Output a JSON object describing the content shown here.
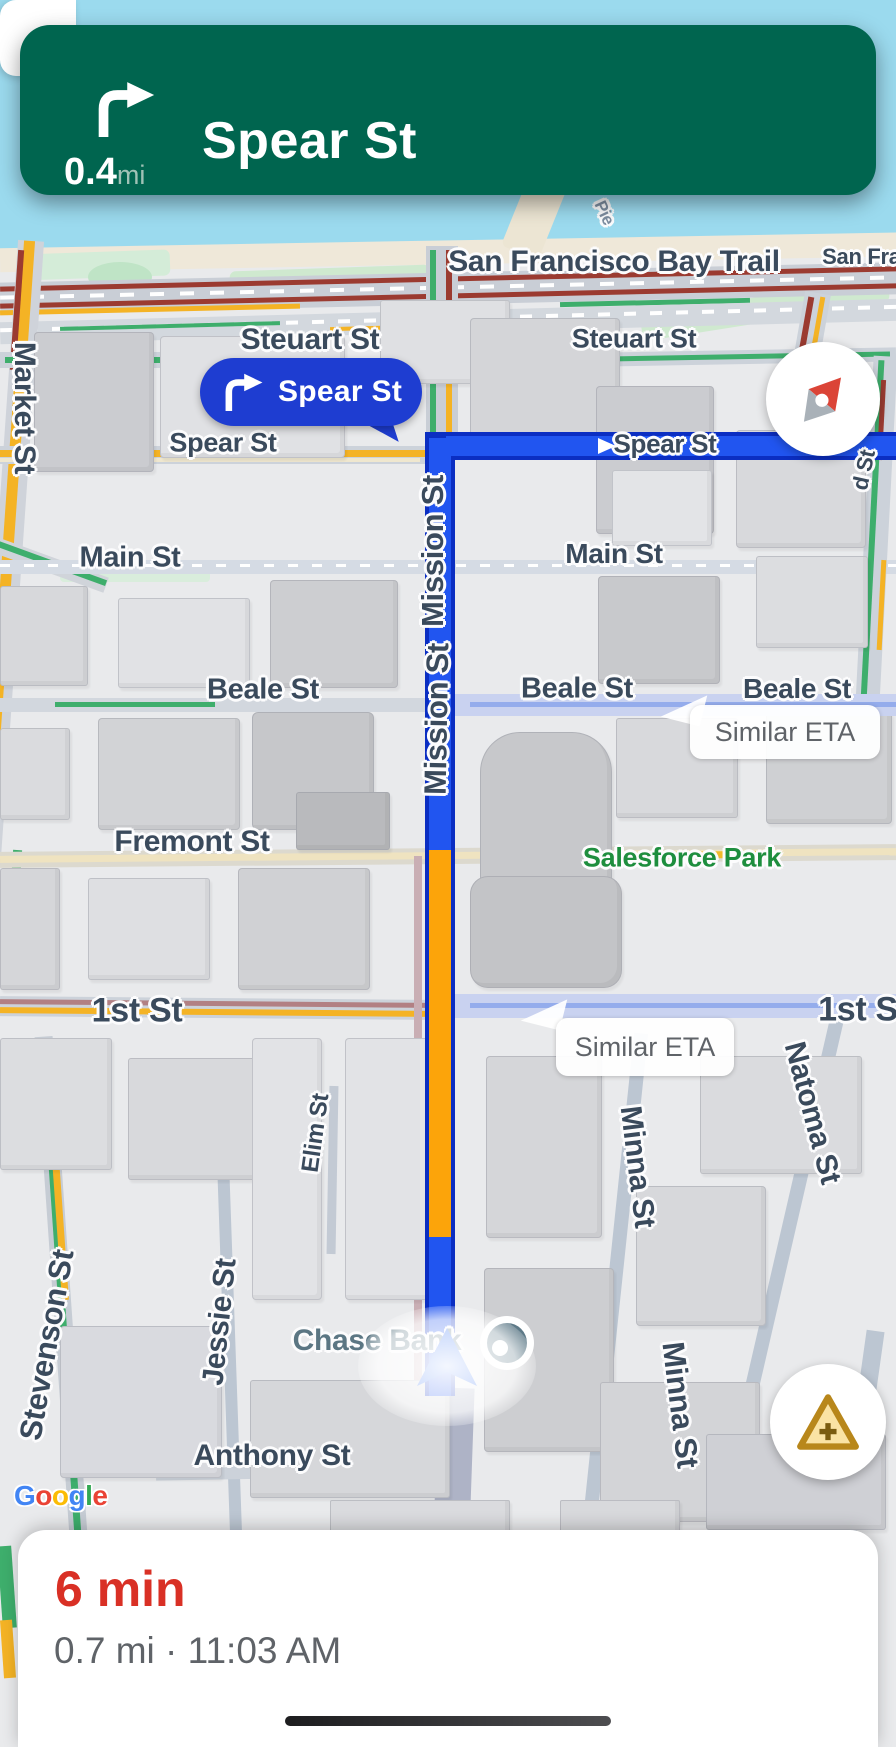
{
  "nav_banner": {
    "instruction": "Spear St",
    "distance_value": "0.4",
    "distance_unit": "mi",
    "maneuver_icon": "turn-right"
  },
  "turn_callout": {
    "label": "Spear St"
  },
  "eta_callouts": [
    "Similar ETA",
    "Similar ETA"
  ],
  "map_controls": {
    "collapse_label": "<"
  },
  "bottom_panel": {
    "eta": "6 min",
    "details": "0.7 mi · 11:03 AM"
  },
  "attribution": {
    "letters": [
      {
        "ch": "G",
        "color": "#4285F4"
      },
      {
        "ch": "o",
        "color": "#EA4335"
      },
      {
        "ch": "o",
        "color": "#FBBC05"
      },
      {
        "ch": "g",
        "color": "#4285F4"
      },
      {
        "ch": "l",
        "color": "#34A853"
      },
      {
        "ch": "e",
        "color": "#EA4335"
      }
    ]
  },
  "colors": {
    "banner_green": "#00654F",
    "route_blue": "#2155F0",
    "route_casing": "#0B2EC2",
    "traffic_orange": "#FCA40A",
    "alt_route": "#C9D2F0",
    "eta_red": "#D93025",
    "callout_blue": "#1E3DD1",
    "water": "#9BDAEE"
  },
  "map": {
    "street_labels": [
      {
        "id": "san-francisco-bay-trail",
        "text": "San Francisco Bay Trail",
        "x": 614,
        "y": 262,
        "rot": 0,
        "size": 30
      },
      {
        "id": "san-francisco-2",
        "text": "San Fran",
        "x": 868,
        "y": 257,
        "rot": 0,
        "size": 22
      },
      {
        "id": "pier",
        "text": "Pie",
        "x": 604,
        "y": 213,
        "rot": 65,
        "size": 17,
        "color": "#7D8DA0"
      },
      {
        "id": "market-st",
        "text": "Market St",
        "x": 24,
        "y": 408,
        "rot": 90,
        "size": 30
      },
      {
        "id": "steuart-st-west",
        "text": "Steuart St",
        "x": 310,
        "y": 340,
        "rot": 0,
        "size": 30
      },
      {
        "id": "steuart-st-east",
        "text": "Steuart St",
        "x": 634,
        "y": 339,
        "rot": 0,
        "size": 27
      },
      {
        "id": "spear-st-west",
        "text": "Spear St",
        "x": 223,
        "y": 443,
        "rot": 0,
        "size": 27
      },
      {
        "id": "spear-st-east",
        "text": "Spear St",
        "x": 665,
        "y": 444,
        "rot": 0,
        "size": 26
      },
      {
        "id": "d-st",
        "text": "d St",
        "x": 864,
        "y": 470,
        "rot": -78,
        "size": 22
      },
      {
        "id": "main-st-west",
        "text": "Main St",
        "x": 130,
        "y": 558,
        "rot": 0,
        "size": 29
      },
      {
        "id": "main-st-east",
        "text": "Main St",
        "x": 614,
        "y": 554,
        "rot": 0,
        "size": 28
      },
      {
        "id": "mission-st-north",
        "text": "Mission St",
        "x": 433,
        "y": 551,
        "rot": -90,
        "size": 31
      },
      {
        "id": "mission-st-south",
        "text": "Mission St",
        "x": 437,
        "y": 719,
        "rot": -89,
        "size": 31
      },
      {
        "id": "beale-st-west",
        "text": "Beale St",
        "x": 263,
        "y": 690,
        "rot": 0,
        "size": 29
      },
      {
        "id": "beale-st-mid",
        "text": "Beale St",
        "x": 577,
        "y": 689,
        "rot": 0,
        "size": 29
      },
      {
        "id": "beale-st-east",
        "text": "Beale St",
        "x": 797,
        "y": 689,
        "rot": 0,
        "size": 28
      },
      {
        "id": "fremont-st",
        "text": "Fremont St",
        "x": 192,
        "y": 842,
        "rot": 0,
        "size": 30
      },
      {
        "id": "salesforce-park",
        "text": "Salesforce Park",
        "x": 682,
        "y": 858,
        "rot": 0,
        "size": 27,
        "color": "#1E8E3E"
      },
      {
        "id": "1st-st-west",
        "text": "1st St",
        "x": 137,
        "y": 1011,
        "rot": 0,
        "size": 34
      },
      {
        "id": "1st-st-east",
        "text": "1st S",
        "x": 858,
        "y": 1010,
        "rot": 0,
        "size": 34
      },
      {
        "id": "natoma-st",
        "text": "Natoma St",
        "x": 812,
        "y": 1113,
        "rot": 75,
        "size": 30
      },
      {
        "id": "elim-st",
        "text": "Elim St",
        "x": 316,
        "y": 1133,
        "rot": -82,
        "size": 24
      },
      {
        "id": "minna-st-north",
        "text": "Minna St",
        "x": 637,
        "y": 1167,
        "rot": 83,
        "size": 30
      },
      {
        "id": "minna-st-south",
        "text": "Minna St",
        "x": 680,
        "y": 1405,
        "rot": 83,
        "size": 31
      },
      {
        "id": "stevenson-st",
        "text": "Stevenson St",
        "x": 47,
        "y": 1345,
        "rot": -80,
        "size": 31
      },
      {
        "id": "jessie-st",
        "text": "Jessie St",
        "x": 220,
        "y": 1322,
        "rot": -84,
        "size": 30
      },
      {
        "id": "chase-bank",
        "text": "Chase Bank",
        "x": 377,
        "y": 1341,
        "rot": 0,
        "size": 30,
        "color": "#5B7683"
      },
      {
        "id": "anthony-st",
        "text": "Anthony St",
        "x": 272,
        "y": 1456,
        "rot": 0,
        "size": 30
      }
    ]
  }
}
